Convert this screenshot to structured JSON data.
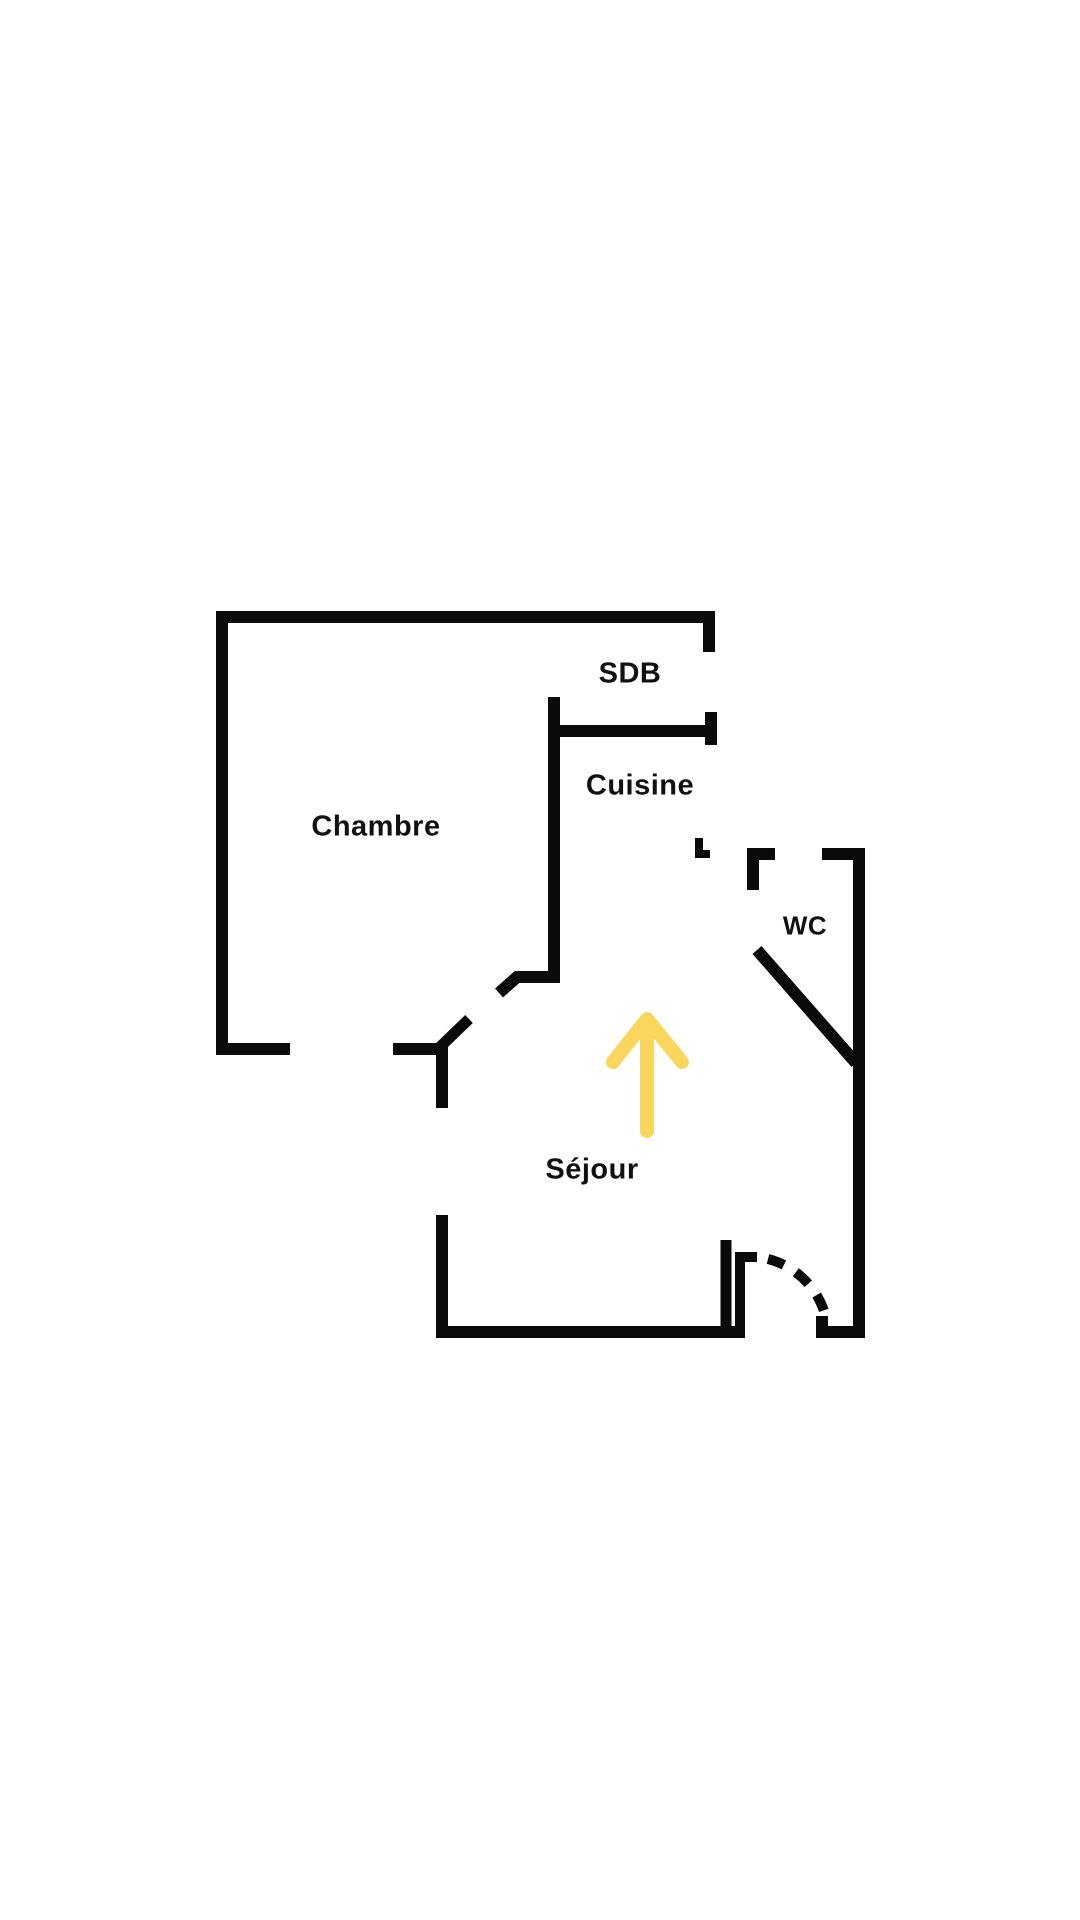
{
  "floorplan": {
    "rooms": [
      {
        "id": "chambre",
        "label": "Chambre"
      },
      {
        "id": "sdb",
        "label": "SDB"
      },
      {
        "id": "cuisine",
        "label": "Cuisine"
      },
      {
        "id": "wc",
        "label": "WC"
      },
      {
        "id": "sejour",
        "label": "Séjour"
      }
    ],
    "icons": {
      "direction_arrow": "up-arrow"
    },
    "colors": {
      "wall": "#0a0a0a",
      "arrow": "#FAD65C",
      "background": "#ffffff"
    }
  }
}
